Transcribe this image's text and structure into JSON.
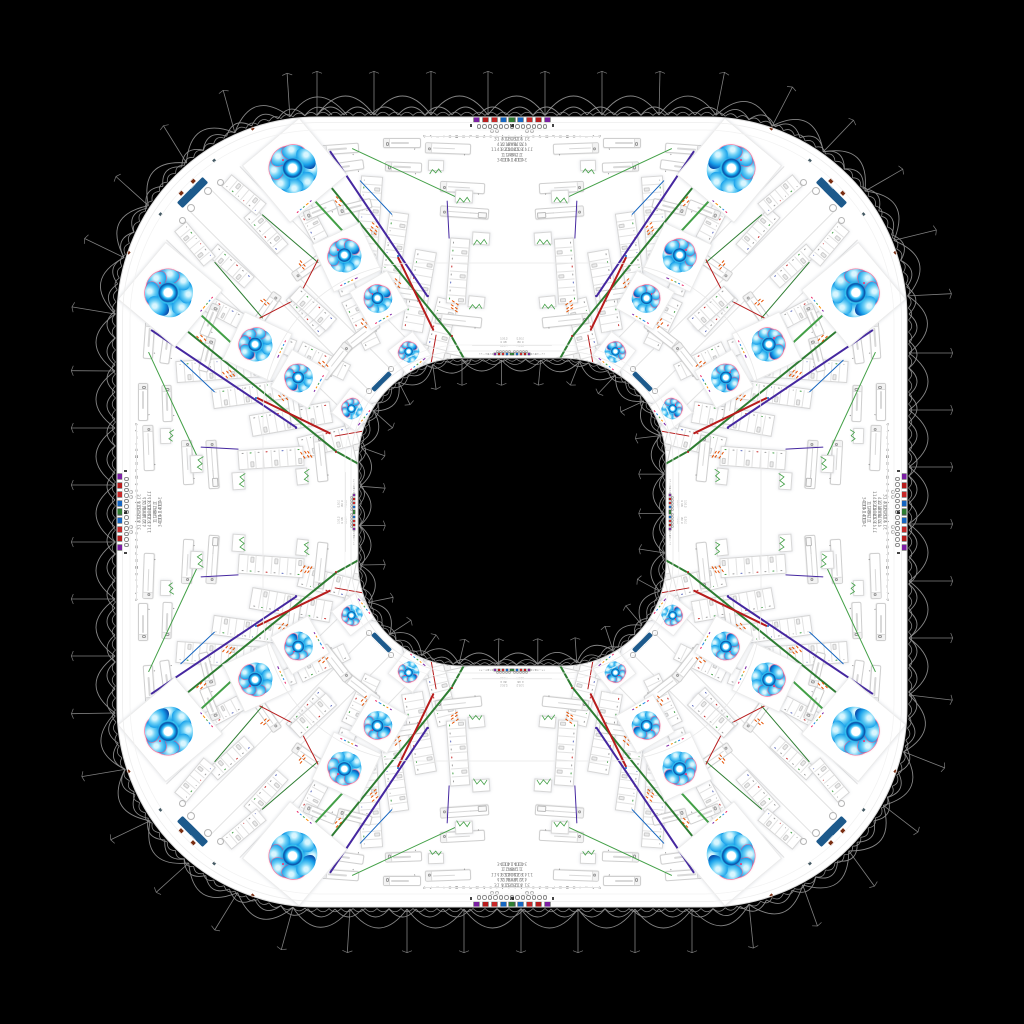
{
  "scene": {
    "bg": "#000000",
    "ring_color": "#ffffff",
    "hole_color": "#000000",
    "lace_color": "#8d8d8d"
  },
  "geometry": {
    "outer": {
      "left": 117,
      "top": 117,
      "size": 790,
      "radius": 200
    },
    "hole": {
      "left": 358,
      "top": 358,
      "size": 308,
      "radius": 104
    },
    "seam": {
      "left": 263,
      "top": 263,
      "size": 498,
      "radius": 152
    }
  },
  "toolbar": {
    "icon_colors": [
      "#7b1fa2",
      "#b71c1c",
      "#c62828",
      "#1565c0",
      "#2e7d32"
    ],
    "glyphs": "↻ ✎ ▭ ▾ ⊞ ▦ ◫ ⇄ ▤ ◔ ≡ ▾ ✚ ⌂",
    "dots": 7,
    "stats_left": "31 312\n412 4\n1141 21\n1 2\n341 1",
    "stats_right": "4 1321\n4 1748\n8 11041\n1 148\n110 141"
  },
  "inner_toolbar": {
    "glyphs": "↻✎▭⊞▦⇄▤≡",
    "stats": "1312\n4 48\n1104"
  },
  "buttons": {
    "color": "#1d5a8c",
    "outer_label": "EXPORT",
    "inner_label": "VIEW",
    "chevron": "▸"
  },
  "palette": {
    "green": "#2e7d32",
    "green2": "#43a047",
    "purple": "#4527a0",
    "red": "#b71c1c",
    "orange": "#e65100",
    "blue": "#1565c0",
    "pink": "#ec407a"
  },
  "octant": {
    "flowers": [
      {
        "x": 293,
        "y": 169,
        "s": 50,
        "rot": -8,
        "prot": -40
      },
      {
        "x": 345,
        "y": 256,
        "s": 35,
        "rot": -18,
        "prot": -25
      },
      {
        "x": 378,
        "y": 299,
        "s": 29,
        "rot": -22,
        "prot": -30
      },
      {
        "x": 409,
        "y": 352,
        "s": 21,
        "rot": -30,
        "prot": -38
      }
    ],
    "buttons": [
      {
        "x": 196,
        "y": 189,
        "w": 26,
        "h": 7.5,
        "rot": -45,
        "which": "outer"
      },
      {
        "x": 385,
        "y": 377,
        "w": 13,
        "h": 4.5,
        "rot": -45,
        "which": "inner"
      }
    ],
    "inputs": [
      {
        "x": 383,
        "y": 138,
        "w": 36,
        "h": 8,
        "rot": 0
      },
      {
        "x": 425,
        "y": 143,
        "w": 44,
        "h": 9,
        "rot": 2
      },
      {
        "x": 320,
        "y": 144,
        "w": 37,
        "h": 8,
        "rot": -4
      },
      {
        "x": 322,
        "y": 162,
        "w": 40,
        "h": 8,
        "rot": -8
      },
      {
        "x": 385,
        "y": 162,
        "w": 35,
        "h": 8,
        "rot": 2
      },
      {
        "x": 440,
        "y": 182,
        "w": 43,
        "h": 9,
        "rot": 3
      },
      {
        "x": 337,
        "y": 202,
        "w": 33,
        "h": 8,
        "rot": -14
      },
      {
        "x": 303,
        "y": 205,
        "w": 32,
        "h": 8,
        "rot": -22
      },
      {
        "x": 440,
        "y": 207,
        "w": 47,
        "h": 9,
        "rot": 4,
        "wide": true
      },
      {
        "x": 290,
        "y": 260,
        "w": 40,
        "h": 9,
        "rot": -35
      },
      {
        "x": 383,
        "y": 288,
        "w": 40,
        "h": 9,
        "rot": 8
      },
      {
        "x": 435,
        "y": 315,
        "w": 45,
        "h": 9,
        "rot": 6
      },
      {
        "x": 340,
        "y": 330,
        "w": 40,
        "h": 9,
        "rot": -38
      },
      {
        "x": 443,
        "y": 357,
        "w": 44,
        "h": 9,
        "rot": 12
      }
    ],
    "lists": [
      {
        "x": 358,
        "y": 176,
        "w": 20,
        "h": 88,
        "rot": 4,
        "rows": 12
      },
      {
        "x": 384,
        "y": 212,
        "w": 18,
        "h": 74,
        "rot": 8,
        "rows": 10
      },
      {
        "x": 408,
        "y": 250,
        "w": 20,
        "h": 80,
        "rot": 10,
        "rows": 10
      },
      {
        "x": 300,
        "y": 190,
        "w": 15,
        "h": 52,
        "rot": -28,
        "rows": 7
      },
      {
        "x": 258,
        "y": 206,
        "w": 14,
        "h": 48,
        "rot": -42,
        "rows": 6
      },
      {
        "x": 330,
        "y": 238,
        "w": 16,
        "h": 56,
        "rot": -20,
        "rows": 7
      },
      {
        "x": 428,
        "y": 298,
        "w": 20,
        "h": 74,
        "rot": 14,
        "rows": 9
      },
      {
        "x": 300,
        "y": 288,
        "w": 15,
        "h": 48,
        "rot": -42,
        "rows": 6
      },
      {
        "x": 352,
        "y": 296,
        "w": 16,
        "h": 52,
        "rot": -26,
        "rows": 7
      },
      {
        "x": 404,
        "y": 342,
        "w": 16,
        "h": 54,
        "rot": 16,
        "rows": 7
      },
      {
        "x": 448,
        "y": 238,
        "w": 18,
        "h": 64,
        "rot": 4,
        "rows": 8
      },
      {
        "x": 236,
        "y": 172,
        "w": 14,
        "h": 44,
        "rot": -50,
        "rows": 6
      }
    ],
    "lines": [
      {
        "x1": 318,
        "y1": 170,
        "x2": 452,
        "y2": 336,
        "c": "green",
        "w": 2
      },
      {
        "x1": 293,
        "y1": 176,
        "x2": 352,
        "y2": 240,
        "c": "green2",
        "w": 1.5
      },
      {
        "x1": 452,
        "y1": 336,
        "x2": 470,
        "y2": 368,
        "c": "green",
        "w": 1.5
      },
      {
        "x1": 352,
        "y1": 148,
        "x2": 455,
        "y2": 196,
        "c": "green2",
        "w": 1.1
      },
      {
        "x1": 398,
        "y1": 362,
        "x2": 448,
        "y2": 410,
        "c": "green",
        "w": 1.3
      },
      {
        "x1": 262,
        "y1": 214,
        "x2": 318,
        "y2": 262,
        "c": "green",
        "w": 1.3
      },
      {
        "x1": 330,
        "y1": 150,
        "x2": 428,
        "y2": 296,
        "c": "purple",
        "w": 1.7
      },
      {
        "x1": 447,
        "y1": 200,
        "x2": 449,
        "y2": 238,
        "c": "purple",
        "w": 1.3
      },
      {
        "x1": 398,
        "y1": 256,
        "x2": 434,
        "y2": 330,
        "c": "red",
        "w": 1.5
      },
      {
        "x1": 330,
        "y1": 236,
        "x2": 302,
        "y2": 290,
        "c": "red",
        "w": 1.1
      },
      {
        "x1": 436,
        "y1": 334,
        "x2": 430,
        "y2": 368,
        "c": "red",
        "w": 1.3
      },
      {
        "x1": 360,
        "y1": 180,
        "x2": 392,
        "y2": 214,
        "c": "blue",
        "w": 0.8
      },
      {
        "x1": 424,
        "y1": 136,
        "x2": 512,
        "y2": 136,
        "c": "#e3e3e3",
        "w": 0.8
      },
      {
        "x1": 472,
        "y1": 345,
        "x2": 512,
        "y2": 345,
        "c": "#e6e6e6",
        "w": 0.5
      }
    ],
    "dashes": [
      {
        "x": 372,
        "y": 222,
        "rot": 40,
        "n": 3
      },
      {
        "x": 395,
        "y": 278,
        "rot": 42,
        "n": 2
      },
      {
        "x": 362,
        "y": 318,
        "rot": 45,
        "n": 2
      },
      {
        "x": 300,
        "y": 260,
        "rot": 48,
        "n": 2
      },
      {
        "x": 452,
        "y": 300,
        "rot": 35,
        "n": 3
      },
      {
        "x": 428,
        "y": 368,
        "rot": 30,
        "n": 2
      },
      {
        "x": 336,
        "y": 196,
        "rot": 44,
        "n": 2
      }
    ],
    "dots": [
      {
        "x": 452,
        "y": 336,
        "c": "red"
      },
      {
        "x": 428,
        "y": 296,
        "c": "purple"
      },
      {
        "x": 398,
        "y": 256,
        "c": "blue"
      },
      {
        "x": 318,
        "y": 170,
        "c": "green"
      },
      {
        "x": 470,
        "y": 368,
        "c": "green"
      }
    ],
    "sparks": [
      {
        "x": 455,
        "y": 190,
        "w": 16,
        "h": 11,
        "rot": 3
      },
      {
        "x": 472,
        "y": 232,
        "w": 16,
        "h": 11,
        "rot": 4
      },
      {
        "x": 428,
        "y": 160,
        "w": 14,
        "h": 9,
        "rot": 2
      },
      {
        "x": 468,
        "y": 296,
        "w": 15,
        "h": 10,
        "rot": 6
      },
      {
        "x": 300,
        "y": 172,
        "w": 13,
        "h": 9,
        "rot": -15
      }
    ],
    "circles": [
      {
        "x": 207,
        "y": 190,
        "r": 3
      },
      {
        "x": 219,
        "y": 181,
        "r": 2.5
      },
      {
        "x": 491,
        "y": 130,
        "r": 1.4
      },
      {
        "x": 496,
        "y": 130,
        "r": 1.4
      },
      {
        "x": 390,
        "y": 368,
        "r": 1.6
      }
    ],
    "marks": [
      {
        "x": 193,
        "y": 181,
        "c": "#7a2e12",
        "s": 4
      },
      {
        "x": 252,
        "y": 128,
        "c": "#7a2e12",
        "s": 3
      },
      {
        "x": 214,
        "y": 160,
        "c": "#455a64",
        "s": 2.5
      }
    ],
    "fans": [
      {
        "x1": 212,
        "y1": 190,
        "x2": 390,
        "y2": 368
      },
      {
        "x1": 240,
        "y1": 166,
        "x2": 414,
        "y2": 346
      }
    ]
  }
}
